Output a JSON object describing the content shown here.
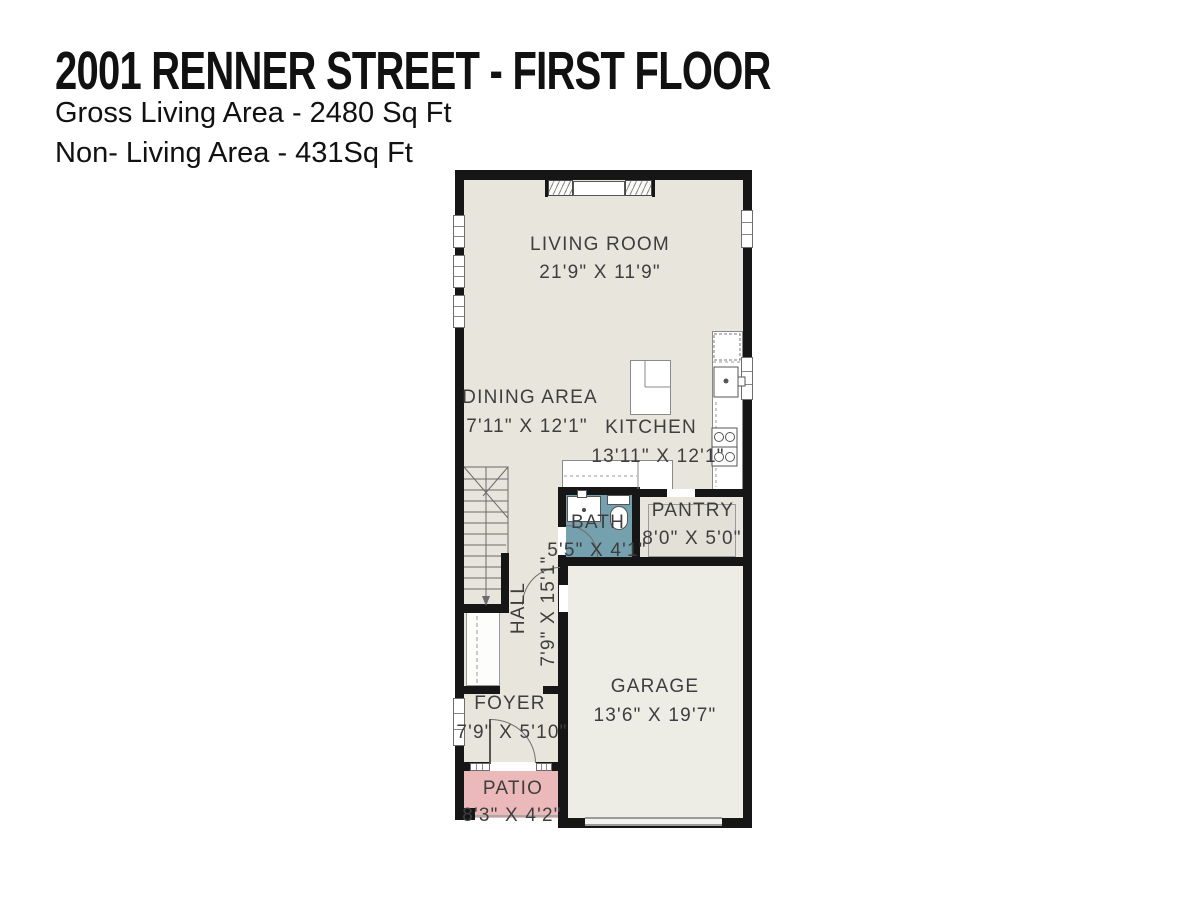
{
  "header": {
    "title": "2001 RENNER STREET - FIRST FLOOR",
    "gross_living": "Gross Living Area - 2480 Sq Ft",
    "non_living": "Non- Living Area - 431Sq Ft"
  },
  "rooms": {
    "living_room": {
      "label": "LIVING ROOM",
      "dims": "21'9\" X 11'9\""
    },
    "dining_area": {
      "label": "DINING AREA",
      "dims": "7'11\" X 12'1\""
    },
    "kitchen": {
      "label": "KITCHEN",
      "dims": "13'11\" X 12'1\""
    },
    "bath": {
      "label": "BATH",
      "dims": "5'5\" X 4'1\""
    },
    "pantry": {
      "label": "PANTRY",
      "dims": "8'0\" X 5'0\""
    },
    "hall": {
      "label": "HALL",
      "dims": "7'9\" X 15'1\""
    },
    "garage": {
      "label": "GARAGE",
      "dims": "13'6\" X 19'7\""
    },
    "foyer": {
      "label": "FOYER",
      "dims": "7'9\" X 5'10\""
    },
    "patio": {
      "label": "PATIO",
      "dims": "8'3\" X 4'2\""
    }
  },
  "colors": {
    "wall": "#161616",
    "main_floor": "#e8e5dc",
    "garage_floor": "#edece5",
    "bath_floor": "#74a1ad",
    "patio_floor": "#ecb9ba",
    "label_text": "#3e3e3e"
  }
}
